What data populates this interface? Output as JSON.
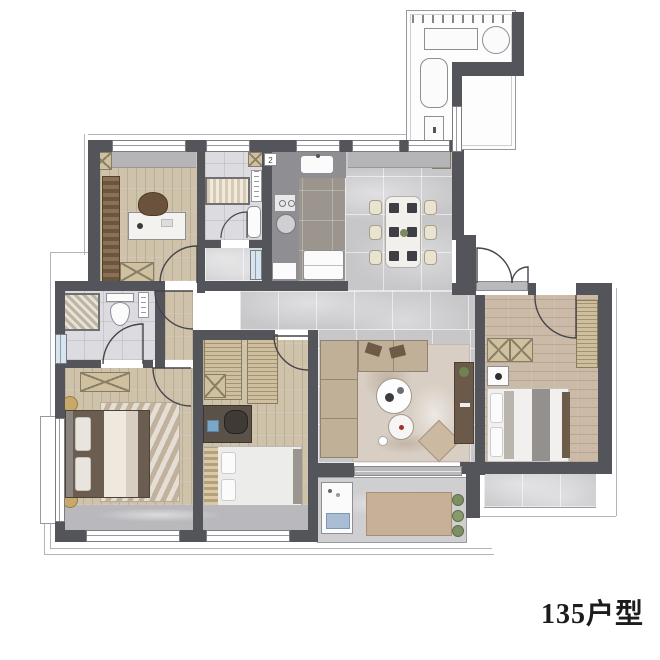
{
  "plan": {
    "title": "135户型",
    "kitchen_marker": "2",
    "palette": {
      "wall": "#54555a",
      "wood_floor": "#cfc2ab",
      "tile_floor": "#c7c7ca",
      "kitchen_floor": "#9b958e",
      "bath_floor": "#dcdce0",
      "window_glass": "#d5e6f0",
      "furniture_tan": "#cfc0a0",
      "furniture_dark": "#6b5949",
      "title_color": "#1c1c1c"
    }
  }
}
